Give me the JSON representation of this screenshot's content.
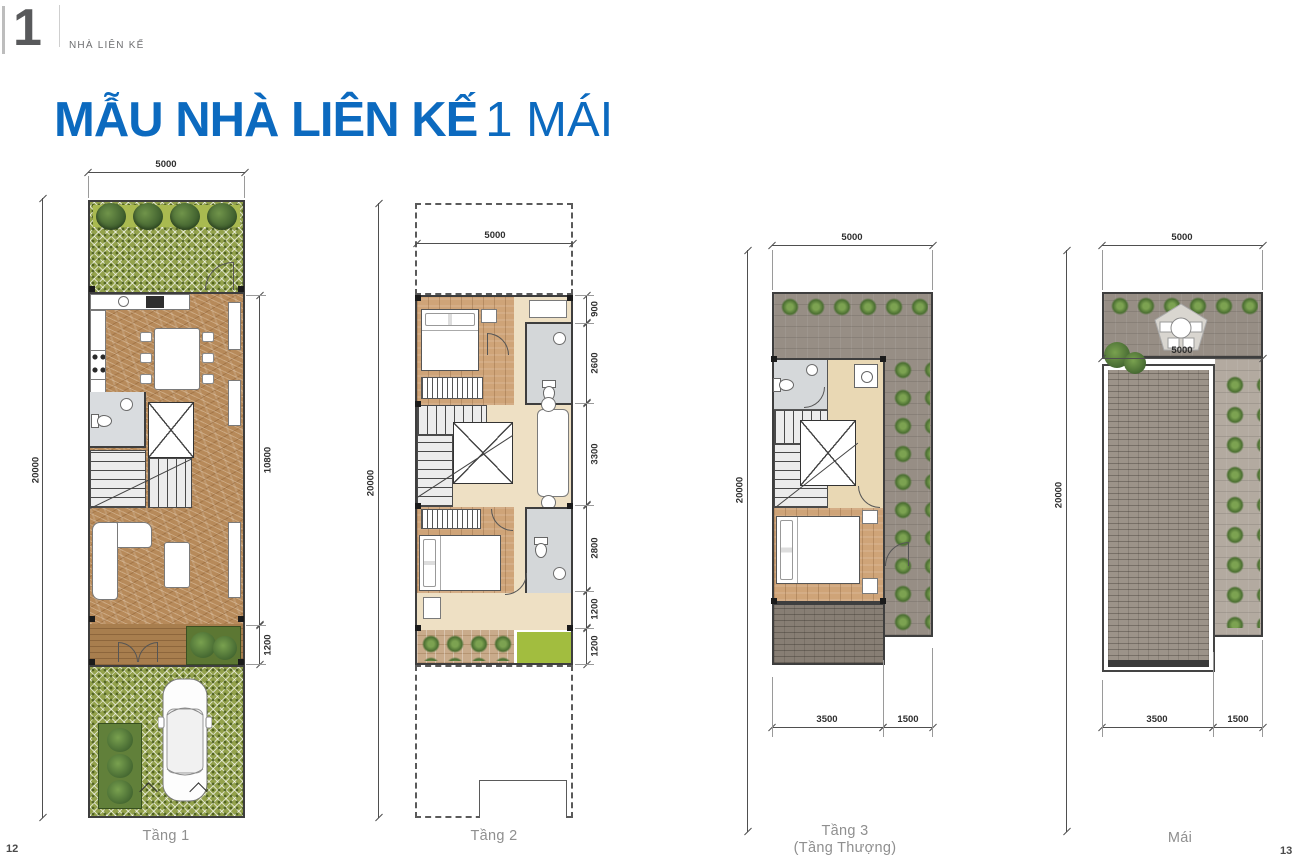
{
  "header": {
    "chapter_number": "1",
    "chapter_label": "NHÀ LIÊN KẾ",
    "title_bold": "MẪU NHÀ LIÊN KẾ",
    "title_light": "1 MÁI"
  },
  "colors": {
    "accent_blue": "#0c6abf",
    "chapter_gray": "#58595b",
    "label_gray": "#8f8f8f"
  },
  "plans": [
    {
      "id": "tang-1",
      "label": "Tầng 1",
      "dim_top": "5000",
      "dim_left": "20000",
      "dims_right": [
        "10800",
        "1200"
      ]
    },
    {
      "id": "tang-2",
      "label": "Tầng 2",
      "dim_top": "5000",
      "dim_left": "20000",
      "dims_right": [
        "900",
        "2600",
        "3300",
        "2800",
        "1200",
        "1200"
      ]
    },
    {
      "id": "tang-3",
      "label": "Tầng 3",
      "label_sub": "(Tầng Thượng)",
      "dim_top": "5000",
      "dim_left": "20000",
      "dims_bottom": [
        "3500",
        "1500"
      ]
    },
    {
      "id": "mai",
      "label": "Mái",
      "dim_top": "5000",
      "dim_mid": "5000",
      "dim_left": "20000",
      "dims_bottom": [
        "3500",
        "1500"
      ]
    }
  ],
  "footer": {
    "page_left": "12",
    "page_right": "13"
  }
}
